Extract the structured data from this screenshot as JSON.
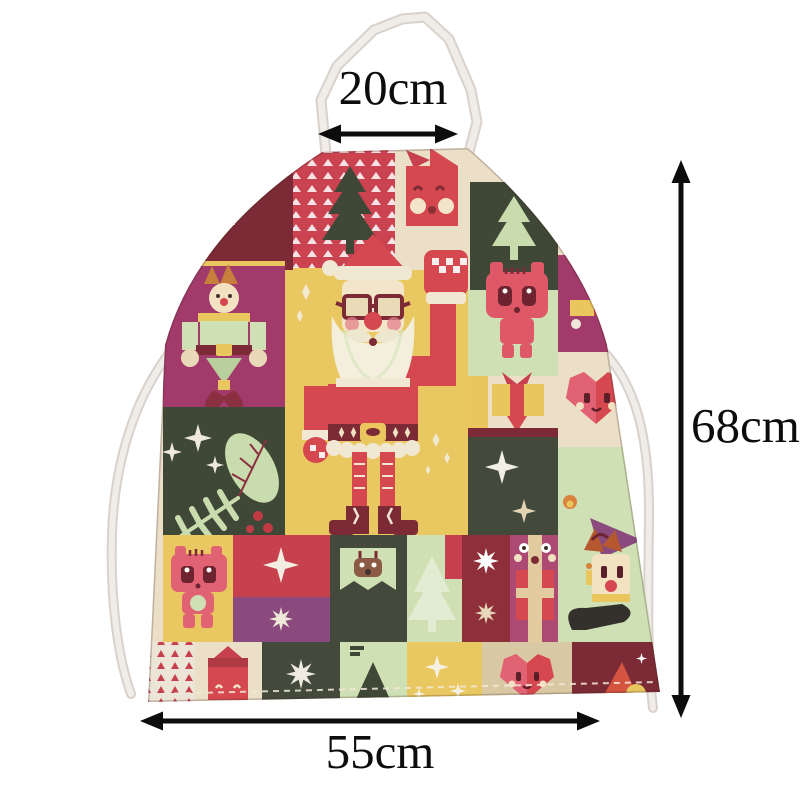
{
  "product": {
    "description": "Christmas patchwork print apron product photo with dimension annotations",
    "background_color": "#ffffff"
  },
  "labels": {
    "neck": "20cm",
    "height": "68cm",
    "width": "55cm"
  },
  "annotations": {
    "neck_width": {
      "value": "20cm",
      "arrow": "horizontal-double-headed"
    },
    "body_height": {
      "value": "68cm",
      "arrow": "vertical-double-headed"
    },
    "body_width": {
      "value": "55cm",
      "arrow": "horizontal-double-headed"
    },
    "arrow_color": "#0d0d0d"
  },
  "apron": {
    "straps": {
      "neck_strap": "white fabric loop",
      "waist_ties_count": 2,
      "color": "#efebe7"
    },
    "print": {
      "style": "christmas-patchwork",
      "motifs": [
        "santa-claus",
        "christmas-tree",
        "gift-box",
        "teddy-bear",
        "heart-face",
        "four-point-star",
        "eight-point-star",
        "elf-nutcracker",
        "jester",
        "reindeer-banner",
        "oak-leaf-and-fern",
        "triangle-pattern",
        "candy-mitten",
        "sparkles"
      ],
      "palette": {
        "yellow": "#eac861",
        "red": "#d0434f",
        "dark_red": "#7c2a35",
        "magenta": "#a23a6b",
        "purple": "#8a4a7e",
        "dark_green": "#3f4836",
        "mint": "#cfe0b4",
        "cream": "#ebdfc8",
        "pink": "#e06273",
        "tan": "#d9c8a4"
      }
    }
  }
}
